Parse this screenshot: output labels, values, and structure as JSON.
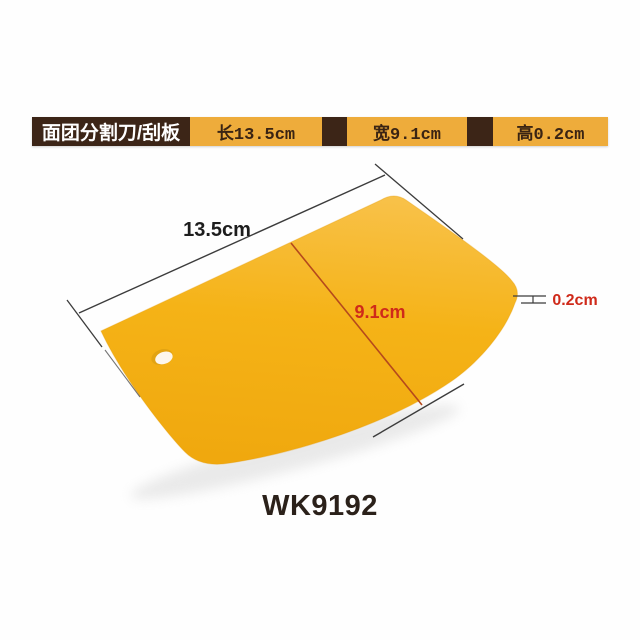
{
  "header": {
    "title": "面团分割刀/刮板",
    "specs": [
      {
        "label": "长13.5cm"
      },
      {
        "label": "宽9.1cm"
      },
      {
        "label": "高0.2cm"
      }
    ],
    "colors": {
      "brown": "#3c2517",
      "yellow": "#eeac3b",
      "title_text": "#ffffff",
      "spec_text": "#3a2413"
    }
  },
  "product": {
    "type": "dough-scraper",
    "code": "WK9192",
    "dimensions": {
      "length": "13.5cm",
      "width": "9.1cm",
      "height": "0.2cm"
    },
    "colors": {
      "body_light": "#f8c148",
      "body": "#f5b317",
      "body_dark": "#f0a80e",
      "body_edge": "#e59c07",
      "dim_line": "#3c3c3c",
      "red_line": "#b5491c",
      "red_text": "#cf2a1a",
      "length_text": "#1d1d1d",
      "hole_rim": "#e2a312",
      "hole_fill": "#fdf6ec",
      "shadow": "#c9c9c9"
    }
  }
}
